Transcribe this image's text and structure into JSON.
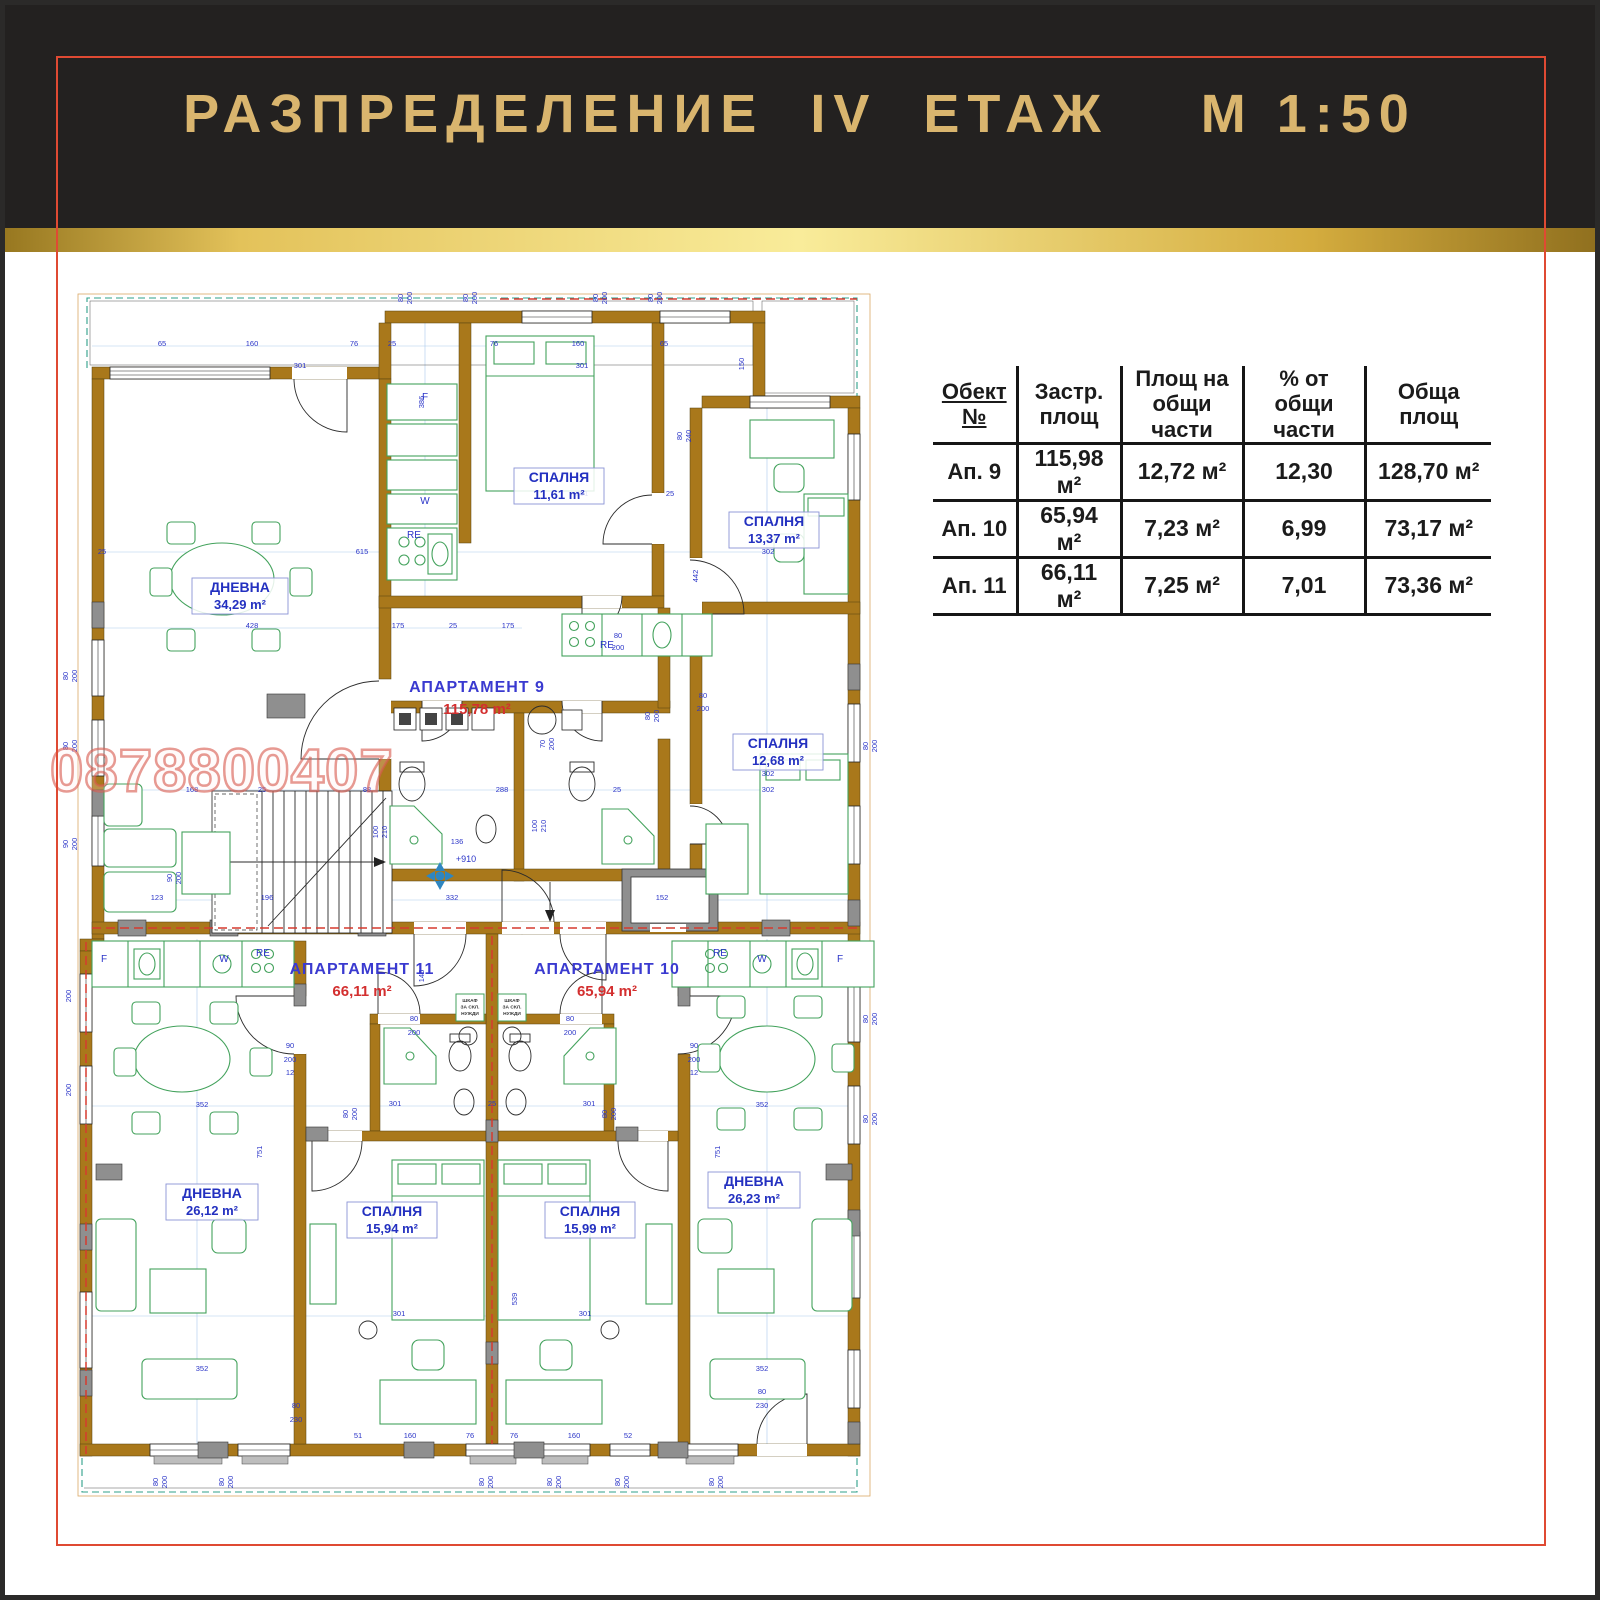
{
  "header": {
    "title": "РАЗПРЕДЕЛЕНИЕ  IV  ЕТАЖ    М 1:50"
  },
  "watermark": {
    "phone": "0878800407"
  },
  "table": {
    "columns": [
      "Обект №",
      "Застр.\nплощ",
      "Площ на\nобщи части",
      "%  от\nобщи части",
      "Обща\nплощ"
    ],
    "rows": [
      [
        "Ап. 9",
        "115,98 м²",
        "12,72 м²",
        "12,30",
        "128,70 м²"
      ],
      [
        "Ап. 10",
        "65,94 м²",
        "7,23 м²",
        "6,99",
        "73,17 м²"
      ],
      [
        "Ап. 11",
        "66,11 м²",
        "7,25 м²",
        "7,01",
        "73,36 м²"
      ]
    ]
  },
  "plan": {
    "scale_note": "М 1:50",
    "level_mark": "+910",
    "apartments": [
      {
        "name": "АПАРТАМЕНТ  9",
        "area": "115,78 m²",
        "x": 415,
        "y": 408
      },
      {
        "name": "АПАРТАМЕНТ  11",
        "area": "66,11 m²",
        "x": 300,
        "y": 690
      },
      {
        "name": "АПАРТАМЕНТ  10",
        "area": "65,94 m²",
        "x": 545,
        "y": 690
      }
    ],
    "rooms": [
      {
        "name": "ДНЕВНА",
        "area": "34,29 m²",
        "x": 178,
        "y": 296,
        "w": 96
      },
      {
        "name": "СПАЛНЯ",
        "area": "11,61 m²",
        "x": 497,
        "y": 186,
        "w": 90
      },
      {
        "name": "СПАЛНЯ",
        "area": "13,37 m²",
        "x": 712,
        "y": 230,
        "w": 90
      },
      {
        "name": "СПАЛНЯ",
        "area": "12,68 m²",
        "x": 716,
        "y": 452,
        "w": 90
      },
      {
        "name": "ДНЕВНА",
        "area": "26,12 m²",
        "x": 150,
        "y": 902,
        "w": 92
      },
      {
        "name": "СПАЛНЯ",
        "area": "15,94 m²",
        "x": 330,
        "y": 920,
        "w": 90
      },
      {
        "name": "СПАЛНЯ",
        "area": "15,99 m²",
        "x": 528,
        "y": 920,
        "w": 90
      },
      {
        "name": "ДНЕВНА",
        "area": "26,23 m²",
        "x": 692,
        "y": 890,
        "w": 92
      }
    ],
    "closets": [
      {
        "x": 394,
        "y": 710,
        "lines": [
          "ШКАФ",
          "ЗА СКЛ.",
          "НУЖДИ"
        ]
      },
      {
        "x": 436,
        "y": 710,
        "lines": [
          "ШКАФ",
          "ЗА СКЛ.",
          "НУЖДИ"
        ]
      }
    ],
    "dimensions": [
      {
        "t": "80",
        "x": 341,
        "y": 14,
        "r": 1
      },
      {
        "t": "200",
        "x": 350,
        "y": 14,
        "r": 1
      },
      {
        "t": "80",
        "x": 406,
        "y": 14,
        "r": 1
      },
      {
        "t": "200",
        "x": 415,
        "y": 14,
        "r": 1
      },
      {
        "t": "80",
        "x": 536,
        "y": 14,
        "r": 1
      },
      {
        "t": "200",
        "x": 545,
        "y": 14,
        "r": 1
      },
      {
        "t": "80",
        "x": 591,
        "y": 14,
        "r": 1
      },
      {
        "t": "200",
        "x": 600,
        "y": 14,
        "r": 1
      },
      {
        "t": "65",
        "x": 100,
        "y": 62
      },
      {
        "t": "160",
        "x": 190,
        "y": 62
      },
      {
        "t": "76",
        "x": 292,
        "y": 62
      },
      {
        "t": "25",
        "x": 330,
        "y": 62
      },
      {
        "t": "76",
        "x": 432,
        "y": 62
      },
      {
        "t": "160",
        "x": 516,
        "y": 62
      },
      {
        "t": "65",
        "x": 602,
        "y": 62
      },
      {
        "t": "301",
        "x": 238,
        "y": 84
      },
      {
        "t": "301",
        "x": 520,
        "y": 84
      },
      {
        "t": "150",
        "x": 682,
        "y": 80,
        "r": 1
      },
      {
        "t": "25",
        "x": 40,
        "y": 270
      },
      {
        "t": "615",
        "x": 300,
        "y": 270
      },
      {
        "t": "25",
        "x": 608,
        "y": 212
      },
      {
        "t": "386",
        "x": 362,
        "y": 118,
        "r": 1
      },
      {
        "t": "80",
        "x": 620,
        "y": 152,
        "r": 1
      },
      {
        "t": "240",
        "x": 629,
        "y": 152,
        "r": 1
      },
      {
        "t": "301",
        "x": 520,
        "y": 212
      },
      {
        "t": "302",
        "x": 706,
        "y": 270
      },
      {
        "t": "442",
        "x": 636,
        "y": 292,
        "r": 1
      },
      {
        "t": "302",
        "x": 706,
        "y": 492
      },
      {
        "t": "428",
        "x": 190,
        "y": 344
      },
      {
        "t": "175",
        "x": 336,
        "y": 344
      },
      {
        "t": "25",
        "x": 391,
        "y": 344
      },
      {
        "t": "175",
        "x": 446,
        "y": 344
      },
      {
        "t": "80",
        "x": 556,
        "y": 354
      },
      {
        "t": "200",
        "x": 556,
        "y": 366
      },
      {
        "t": "80",
        "x": 641,
        "y": 414
      },
      {
        "t": "200",
        "x": 641,
        "y": 427
      },
      {
        "t": "70",
        "x": 483,
        "y": 460,
        "r": 1
      },
      {
        "t": "200",
        "x": 492,
        "y": 460,
        "r": 1
      },
      {
        "t": "80",
        "x": 588,
        "y": 432,
        "r": 1
      },
      {
        "t": "200",
        "x": 597,
        "y": 432,
        "r": 1
      },
      {
        "t": "168",
        "x": 130,
        "y": 508
      },
      {
        "t": "25",
        "x": 200,
        "y": 508
      },
      {
        "t": "88",
        "x": 305,
        "y": 508
      },
      {
        "t": "288",
        "x": 440,
        "y": 508
      },
      {
        "t": "25",
        "x": 555,
        "y": 508
      },
      {
        "t": "302",
        "x": 706,
        "y": 508
      },
      {
        "t": "123",
        "x": 95,
        "y": 616
      },
      {
        "t": "196",
        "x": 205,
        "y": 616
      },
      {
        "t": "332",
        "x": 390,
        "y": 616
      },
      {
        "t": "152",
        "x": 600,
        "y": 616
      },
      {
        "t": "136",
        "x": 395,
        "y": 560
      },
      {
        "t": "100",
        "x": 316,
        "y": 548,
        "r": 1
      },
      {
        "t": "210",
        "x": 325,
        "y": 548,
        "r": 1
      },
      {
        "t": "100",
        "x": 475,
        "y": 542,
        "r": 1
      },
      {
        "t": "210",
        "x": 484,
        "y": 542,
        "r": 1
      },
      {
        "t": "90",
        "x": 110,
        "y": 594,
        "r": 1
      },
      {
        "t": "200",
        "x": 119,
        "y": 594,
        "r": 1
      },
      {
        "t": "145",
        "x": 362,
        "y": 692,
        "r": 1
      },
      {
        "t": "90",
        "x": 228,
        "y": 764
      },
      {
        "t": "200",
        "x": 228,
        "y": 778
      },
      {
        "t": "12",
        "x": 228,
        "y": 791
      },
      {
        "t": "90",
        "x": 632,
        "y": 764
      },
      {
        "t": "200",
        "x": 632,
        "y": 778
      },
      {
        "t": "12",
        "x": 632,
        "y": 791
      },
      {
        "t": "80",
        "x": 352,
        "y": 737
      },
      {
        "t": "200",
        "x": 352,
        "y": 751
      },
      {
        "t": "80",
        "x": 508,
        "y": 737
      },
      {
        "t": "200",
        "x": 508,
        "y": 751
      },
      {
        "t": "80",
        "x": 286,
        "y": 830,
        "r": 1
      },
      {
        "t": "200",
        "x": 295,
        "y": 830,
        "r": 1
      },
      {
        "t": "80",
        "x": 545,
        "y": 830,
        "r": 1
      },
      {
        "t": "200",
        "x": 554,
        "y": 830,
        "r": 1
      },
      {
        "t": "301",
        "x": 333,
        "y": 822
      },
      {
        "t": "25",
        "x": 430,
        "y": 822
      },
      {
        "t": "301",
        "x": 527,
        "y": 822
      },
      {
        "t": "352",
        "x": 140,
        "y": 823
      },
      {
        "t": "352",
        "x": 700,
        "y": 823
      },
      {
        "t": "751",
        "x": 200,
        "y": 868,
        "r": 1
      },
      {
        "t": "751",
        "x": 658,
        "y": 868,
        "r": 1
      },
      {
        "t": "539",
        "x": 455,
        "y": 1015,
        "r": 1
      },
      {
        "t": "301",
        "x": 337,
        "y": 1032
      },
      {
        "t": "301",
        "x": 523,
        "y": 1032
      },
      {
        "t": "352",
        "x": 140,
        "y": 1087
      },
      {
        "t": "352",
        "x": 700,
        "y": 1087
      },
      {
        "t": "80",
        "x": 234,
        "y": 1124
      },
      {
        "t": "230",
        "x": 234,
        "y": 1138
      },
      {
        "t": "80",
        "x": 700,
        "y": 1110
      },
      {
        "t": "230",
        "x": 700,
        "y": 1124
      },
      {
        "t": "51",
        "x": 296,
        "y": 1154
      },
      {
        "t": "160",
        "x": 348,
        "y": 1154
      },
      {
        "t": "76",
        "x": 408,
        "y": 1154
      },
      {
        "t": "76",
        "x": 452,
        "y": 1154
      },
      {
        "t": "160",
        "x": 512,
        "y": 1154
      },
      {
        "t": "52",
        "x": 566,
        "y": 1154
      },
      {
        "t": "80",
        "x": 96,
        "y": 1198,
        "r": 1
      },
      {
        "t": "200",
        "x": 105,
        "y": 1198,
        "r": 1
      },
      {
        "t": "80",
        "x": 162,
        "y": 1198,
        "r": 1
      },
      {
        "t": "200",
        "x": 171,
        "y": 1198,
        "r": 1
      },
      {
        "t": "80",
        "x": 422,
        "y": 1198,
        "r": 1
      },
      {
        "t": "200",
        "x": 431,
        "y": 1198,
        "r": 1
      },
      {
        "t": "80",
        "x": 490,
        "y": 1198,
        "r": 1
      },
      {
        "t": "200",
        "x": 499,
        "y": 1198,
        "r": 1
      },
      {
        "t": "80",
        "x": 558,
        "y": 1198,
        "r": 1
      },
      {
        "t": "200",
        "x": 567,
        "y": 1198,
        "r": 1
      },
      {
        "t": "80",
        "x": 652,
        "y": 1198,
        "r": 1
      },
      {
        "t": "200",
        "x": 661,
        "y": 1198,
        "r": 1
      },
      {
        "t": "80",
        "x": 6,
        "y": 392,
        "r": 1
      },
      {
        "t": "200",
        "x": 15,
        "y": 392,
        "r": 1
      },
      {
        "t": "80",
        "x": 6,
        "y": 462,
        "r": 1
      },
      {
        "t": "200",
        "x": 15,
        "y": 462,
        "r": 1
      },
      {
        "t": "90",
        "x": 6,
        "y": 560,
        "r": 1
      },
      {
        "t": "200",
        "x": 15,
        "y": 560,
        "r": 1
      },
      {
        "t": "80",
        "x": 0,
        "y": 712,
        "r": 1
      },
      {
        "t": "200",
        "x": 9,
        "y": 712,
        "r": 1
      },
      {
        "t": "80",
        "x": 0,
        "y": 806,
        "r": 1
      },
      {
        "t": "200",
        "x": 9,
        "y": 806,
        "r": 1
      },
      {
        "t": "80",
        "x": 806,
        "y": 462,
        "r": 1
      },
      {
        "t": "200",
        "x": 815,
        "y": 462,
        "r": 1
      },
      {
        "t": "80",
        "x": 806,
        "y": 735,
        "r": 1
      },
      {
        "t": "200",
        "x": 815,
        "y": 735,
        "r": 1
      },
      {
        "t": "80",
        "x": 806,
        "y": 835,
        "r": 1
      },
      {
        "t": "200",
        "x": 815,
        "y": 835,
        "r": 1
      },
      {
        "t": "+910",
        "x": 404,
        "y": 578,
        "s": 9,
        "c": "#2E86C1"
      },
      {
        "t": "F",
        "x": 363,
        "y": 116,
        "s": 10
      },
      {
        "t": "W",
        "x": 363,
        "y": 220,
        "s": 10
      },
      {
        "t": "RE",
        "x": 352,
        "y": 254,
        "s": 10
      },
      {
        "t": "RE",
        "x": 545,
        "y": 364,
        "s": 10
      },
      {
        "t": "F",
        "x": 42,
        "y": 678,
        "s": 10
      },
      {
        "t": "W",
        "x": 162,
        "y": 678,
        "s": 10
      },
      {
        "t": "RE",
        "x": 201,
        "y": 672,
        "s": 10
      },
      {
        "t": "RE",
        "x": 658,
        "y": 672,
        "s": 10
      },
      {
        "t": "W",
        "x": 700,
        "y": 678,
        "s": 10
      },
      {
        "t": "F",
        "x": 778,
        "y": 678,
        "s": 10
      }
    ]
  }
}
